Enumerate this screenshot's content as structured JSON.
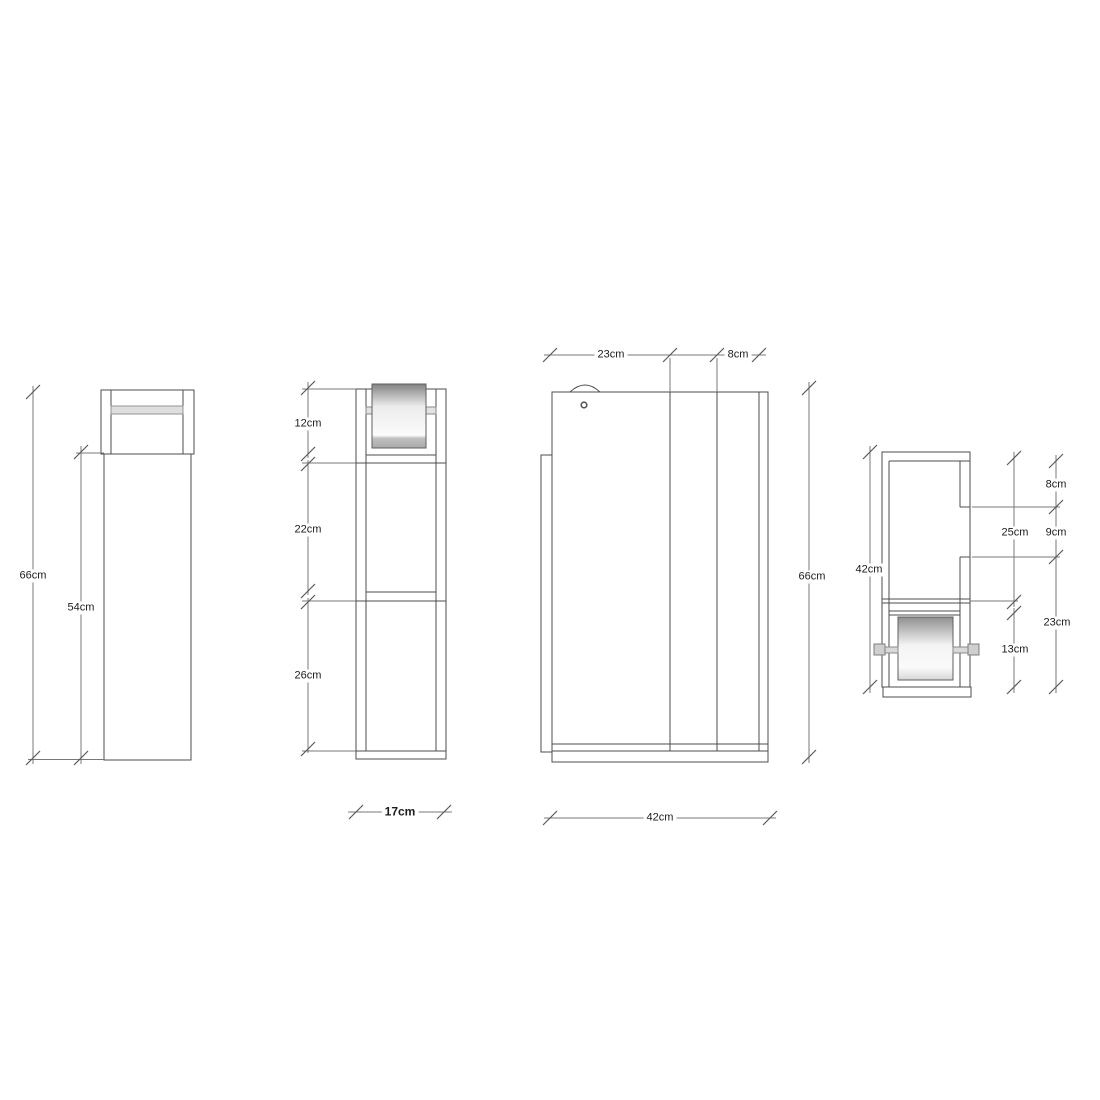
{
  "views": {
    "back": {
      "height_total": "66cm",
      "height_body": "54cm"
    },
    "front": {
      "section_top": "12cm",
      "section_middle": "22cm",
      "section_bottom": "26cm",
      "width": "17cm"
    },
    "side": {
      "depth_front": "23cm",
      "depth_rear": "8cm",
      "height_total": "66cm",
      "depth_total": "42cm"
    },
    "side_detail": {
      "height_inner": "42cm",
      "gap_top": "8cm",
      "opening_side": "9cm",
      "compartment_upper": "25cm",
      "compartment_roll": "13cm",
      "section_lower": "23cm"
    }
  },
  "colors": {
    "background": "#ffffff",
    "outline": "#4d4d4d",
    "dimension_line": "#787878",
    "label_text": "#1c1c1c",
    "roll_shade_dark": "#8a8a8a",
    "hardware_fill": "#dedede"
  }
}
